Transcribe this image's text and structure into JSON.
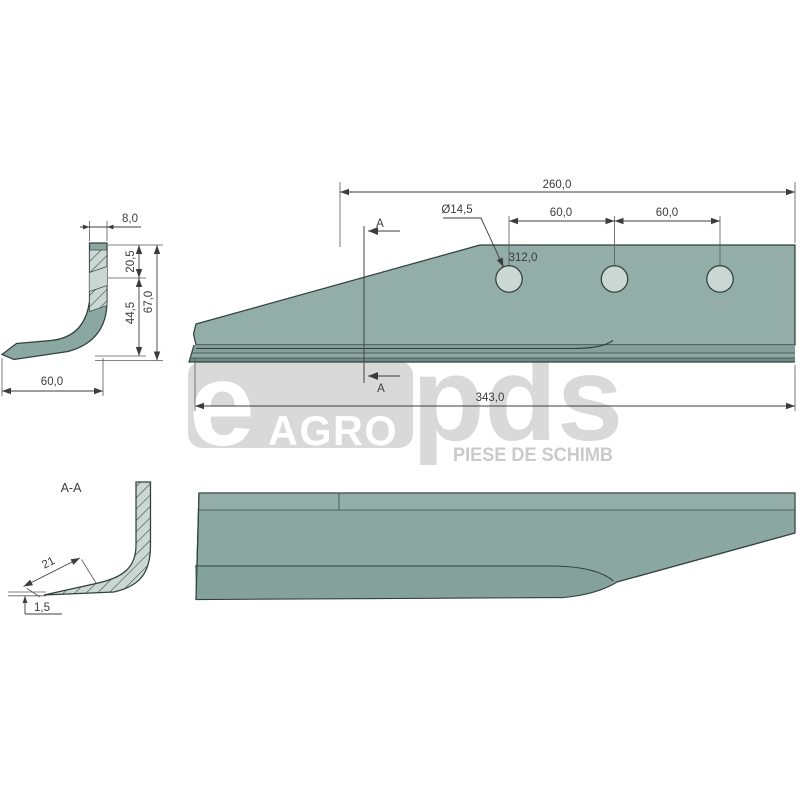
{
  "watermark": {
    "e": "e",
    "agro": "AGRO",
    "pds": "pds",
    "tagline": "PIESE DE SCHIMB"
  },
  "side_view": {
    "dim_top_width": "8,0",
    "dim_upper": "20,5",
    "dim_lower": "44,5",
    "dim_height": "67,0",
    "dim_foot": "60,0"
  },
  "top_view": {
    "dim_length_right": "260,0",
    "dim_hole_dia": "Ø14,5",
    "dim_hole_space_1": "60,0",
    "dim_hole_space_2": "60,0",
    "dim_ref": "312,0",
    "dim_overall": "343,0",
    "section_label_top": "A",
    "section_label_bottom": "A"
  },
  "section_view": {
    "title": "A-A",
    "dim_bevel": "21",
    "dim_tip": "1,5"
  },
  "colors": {
    "steel": "#8ba7a2",
    "steel_strip_light": "#93ada8",
    "steel_band_dark": "#7e9894",
    "steel_band_darker": "#6e8b86",
    "steel_light": "#cbd7d3",
    "outline": "#30403e",
    "dimension": "#3c3c3c",
    "watermark_gray": "#d9d9d9",
    "watermark_tagline": "#cacaca"
  }
}
